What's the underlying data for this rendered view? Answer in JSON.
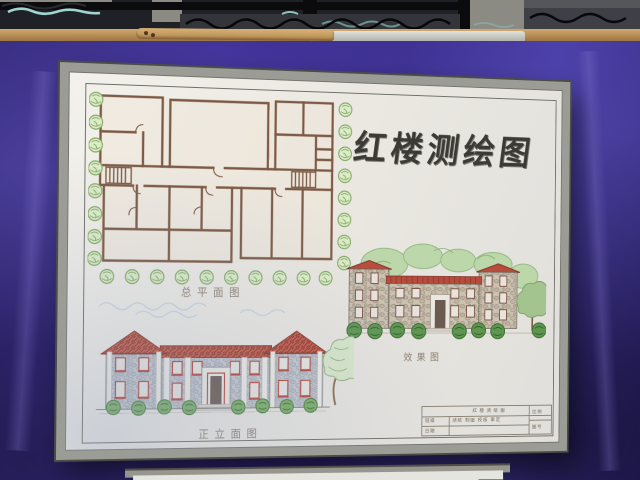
{
  "board": {
    "title": "红楼测绘图",
    "labels": {
      "plan": "总平面图",
      "rendering": "效果图",
      "elevation": "正立面图"
    },
    "title_block": {
      "title": "红楼测绘图",
      "left_top": "班级",
      "left_bottom": "日期",
      "center_top": "测绘 制图 校核 审定",
      "center_bottom": "",
      "right_top": "比例",
      "right_bottom": "图号"
    }
  },
  "colors": {
    "backdrop_purple": "#3a2d8f",
    "board_frame": "#9c9c96",
    "paper": "#ece9e2",
    "plan_wall_brown": "#7d5a45",
    "roof_red": "#b5453a",
    "stone_blue_gray": "#c6c9cd",
    "tree_green": "#86ab68",
    "title_ink": "#3b3a35"
  }
}
